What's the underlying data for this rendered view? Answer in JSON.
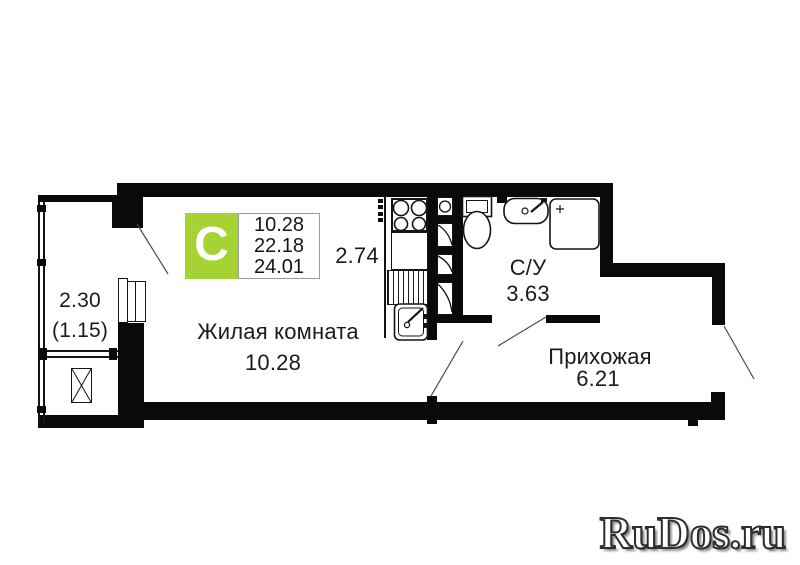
{
  "badge": {
    "letter": "С",
    "areas": [
      "10.28",
      "22.18",
      "24.01"
    ],
    "color": "#a6d334"
  },
  "rooms": {
    "living": {
      "name": "Жилая комната",
      "area": "10.28"
    },
    "kitchen": {
      "area": "2.74"
    },
    "bathroom": {
      "name": "С/У",
      "area": "3.63"
    },
    "hallway": {
      "name": "Прихожая",
      "area": "6.21"
    },
    "balcony": {
      "area": "2.30",
      "reduced_area": "(1.15)"
    }
  },
  "watermark": {
    "text": "RuDos.ru"
  },
  "colors": {
    "wall": "#0a0a0a",
    "badge_green": "#a6d334",
    "text": "#1b1b1b"
  }
}
